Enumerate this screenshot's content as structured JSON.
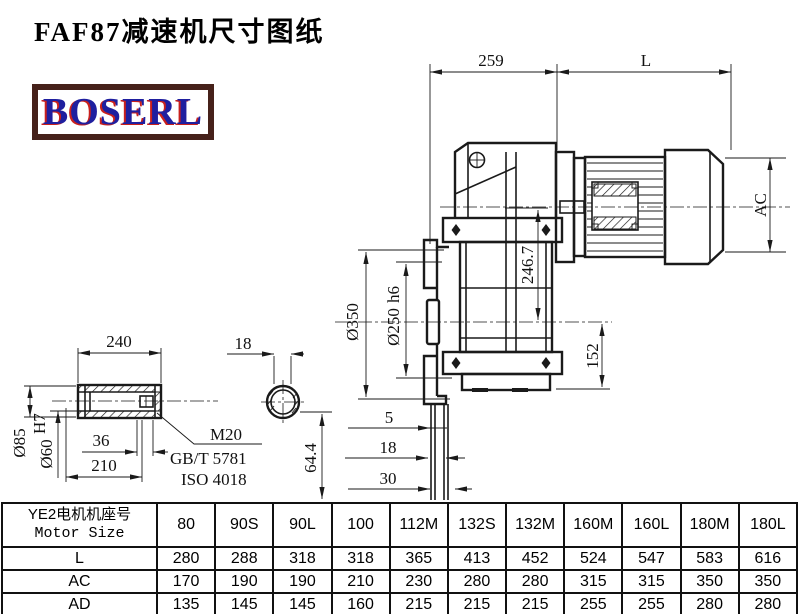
{
  "title": "FAF87减速机尺寸图纸",
  "logo": {
    "text": "BOSERL",
    "border_color": "#46211a",
    "text_color": "#1f1f9f",
    "shadow_color": "#c9201d"
  },
  "drawing": {
    "line_color": "#1a1a1a",
    "dims": {
      "top_width": "259",
      "motor_length": "L",
      "motor_ac": "AC",
      "flange_d350": "Ø350",
      "hub_d250": "Ø250",
      "hub_d250_tol": "h6",
      "height_2467": "246.7",
      "height_152": "152",
      "gap_5": "5",
      "gap_18": "18",
      "gap_30": "30",
      "height_644": "64.4",
      "shaft_len_240": "240",
      "key_width_18": "18",
      "shaft_d85": "Ø85",
      "bore_d60": "Ø60",
      "bore_d60_tol": "H7",
      "bolt_depth_36": "36",
      "bore_depth_210": "210",
      "thread": "M20",
      "std1": "GB/T 5781",
      "std2": "ISO 4018"
    }
  },
  "table": {
    "header_cn": "YE2电机机座号",
    "header_en": "Motor Size",
    "columns": [
      "80",
      "90S",
      "90L",
      "100",
      "112M",
      "132S",
      "132M",
      "160M",
      "160L",
      "180M",
      "180L"
    ],
    "rows": [
      {
        "label": "L",
        "values": [
          280,
          288,
          318,
          318,
          365,
          413,
          452,
          524,
          547,
          583,
          616
        ]
      },
      {
        "label": "AC",
        "values": [
          170,
          190,
          190,
          210,
          230,
          280,
          280,
          315,
          315,
          350,
          350
        ]
      },
      {
        "label": "AD",
        "values": [
          135,
          145,
          145,
          160,
          215,
          215,
          215,
          255,
          255,
          280,
          280
        ]
      }
    ]
  }
}
